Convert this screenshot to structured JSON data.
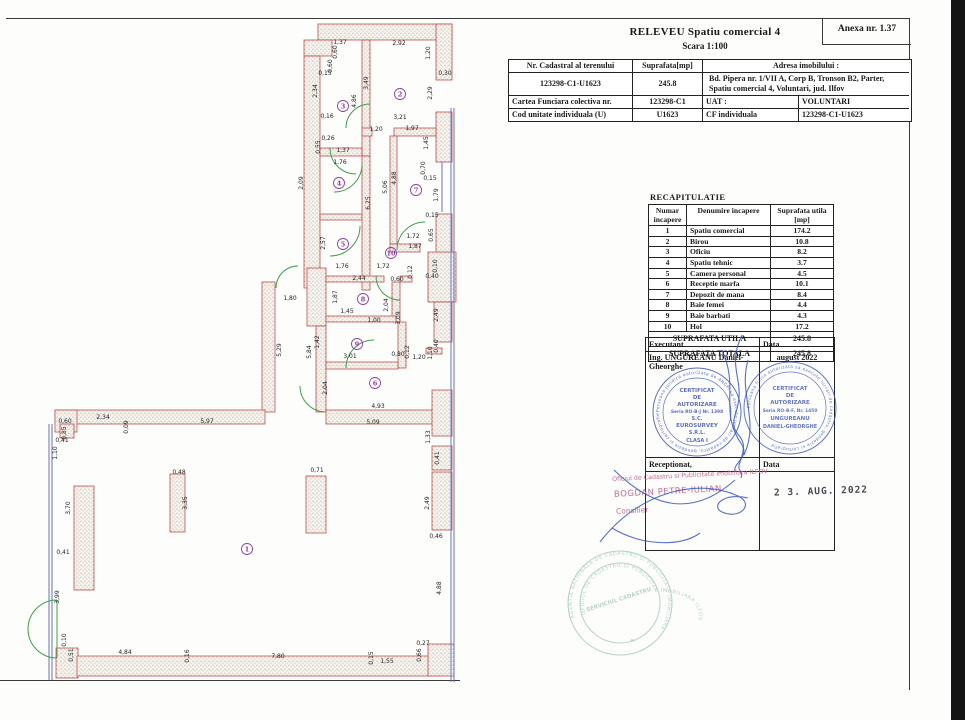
{
  "page": {
    "anexa": "Anexa nr. 1.37",
    "title": "RELEVEU   Spatiu comercial 4",
    "scale": "Scara 1:100"
  },
  "header_table": {
    "col1_label": "Nr. Cadastral al terenului",
    "col2_label": "Suprafata[mp]",
    "col3_label": "Adresa imobilului :",
    "cadastral_no": "123298-C1-U1623",
    "area": "245.8",
    "address": "Bd. Pipera nr. 1/VII A, Corp B, Tronson B2, Parter, Spatiu comercial 4, Voluntari, jud. Ilfov",
    "row3_label": "Cartea Funciara colectiva nr.",
    "row3_value": "123298-C1",
    "row3_label2": "UAT :",
    "row3_value2": "VOLUNTARI",
    "row4_label": "Cod unitate individuala (U)",
    "row4_value": "U1623",
    "row4_label2": "CF individuala",
    "row4_value2": "123298-C1-U1623"
  },
  "recap_table": {
    "title": "RECAPITULATIE",
    "header_col1": "Numar incapere",
    "header_col2": "Denumire incapere",
    "header_col3": "Suprafata utila [mp]",
    "rows": [
      [
        "1",
        "Spatiu comercial",
        "174.2"
      ],
      [
        "2",
        "Birou",
        "10.8"
      ],
      [
        "3",
        "Oficiu",
        "8.2"
      ],
      [
        "4",
        "Spatiu tehnic",
        "3.7"
      ],
      [
        "5",
        "Camera personal",
        "4.5"
      ],
      [
        "6",
        "Receptie marfa",
        "10.1"
      ],
      [
        "7",
        "Depozit de mana",
        "8.4"
      ],
      [
        "8",
        "Baie femei",
        "4.4"
      ],
      [
        "9",
        "Baie barbati",
        "4.3"
      ],
      [
        "10",
        "Hol",
        "17.2"
      ]
    ],
    "total_util_label": "SUPRAFATA UTILA",
    "total_util": "245.8",
    "total_label": "SUPRAFATA TOTALA",
    "total": "245.8"
  },
  "signature_table": {
    "executant_label": "Executant",
    "data_label": "Data",
    "executant": "Ing. UNGUREANU Daniel-Gheorghe",
    "executant_date": "august 2022",
    "receptionat_label": "Receptionat,",
    "data_label2": "Data",
    "reception_stamp_line1": "Oficiul de Cadastru si Publicitate Imobiliara ILFOV",
    "reception_stamp_line2": "BOGDAN PETRE-IULIAN",
    "reception_stamp_line3": "Consilier",
    "reception_date": "2 3. AUG. 2022"
  },
  "stamps": {
    "stamp1_ring": "Persoana juridica autorizata de ANCPI sa execute lucrari de cadastru, geodezie si cartografie",
    "stamp1_lines": [
      "CERTIFICAT",
      "DE",
      "AUTORIZARE",
      "Seria RO-B-J Nr. 1398",
      "S.C.",
      "EUROSURVEY",
      "S.R.L.",
      "CLASA I"
    ],
    "stamp2_ring": "Persoana fizica autorizata sa execute lucrari de cadastru, geodezie si cartografie",
    "stamp2_lines": [
      "CERTIFICAT",
      "DE",
      "AUTORIZARE",
      "Seria RO-B-F, Nr. 1450",
      "UNGUREANU",
      "DANIEL-GHEORGHE"
    ],
    "round_stamp_outer": "AGENTIA NATIONALA DE CADASTRU SI PUBLICITATE IMOBILIARA",
    "round_stamp_inner": "OFICIUL DE CADASTRU SI PUBLICITATE IMOBILIARA ILFOV",
    "round_stamp_center": "SERVICIUL CADASTRU"
  },
  "plan": {
    "colors": {
      "wall": "#c0504d",
      "window": "#6674b8",
      "door": "#3f9e4d",
      "room_number": "#8b3f9e"
    },
    "rooms": [
      [
        1,
        247,
        549
      ],
      [
        2,
        400,
        94
      ],
      [
        3,
        343,
        106
      ],
      [
        4,
        339,
        183
      ],
      [
        5,
        343,
        244
      ],
      [
        6,
        375,
        383
      ],
      [
        7,
        416,
        190
      ],
      [
        8,
        363,
        299
      ],
      [
        9,
        357,
        344
      ],
      [
        10,
        391,
        253
      ]
    ],
    "dims": [
      [
        "1,37",
        340,
        44,
        0
      ],
      [
        "0,60",
        337,
        52,
        1
      ],
      [
        "2,92",
        399,
        45,
        0
      ],
      [
        "1,20",
        430,
        53,
        1
      ],
      [
        "0,60",
        332,
        66,
        1
      ],
      [
        "0,15",
        325,
        75,
        0
      ],
      [
        "0,30",
        445,
        75,
        0
      ],
      [
        "2,34",
        317,
        91,
        1
      ],
      [
        "3,49",
        368,
        83,
        1
      ],
      [
        "4,86",
        356,
        101,
        1
      ],
      [
        "2,29",
        432,
        93,
        1
      ],
      [
        "0,16",
        327,
        118,
        0
      ],
      [
        "3,21",
        400,
        119,
        0
      ],
      [
        "1,20",
        376,
        131,
        0
      ],
      [
        "1,97",
        412,
        130,
        0
      ],
      [
        "1,45",
        428,
        143,
        1
      ],
      [
        "0,26",
        328,
        140,
        0
      ],
      [
        "0,55",
        320,
        147,
        1
      ],
      [
        "1,37",
        343,
        152,
        0
      ],
      [
        "1,76",
        340,
        164,
        0
      ],
      [
        "2,09",
        303,
        183,
        1
      ],
      [
        "6,25",
        370,
        203,
        1
      ],
      [
        "5,06",
        387,
        187,
        1
      ],
      [
        "4,88",
        396,
        178,
        1
      ],
      [
        "0,70",
        425,
        168,
        1
      ],
      [
        "0,15",
        430,
        180,
        0
      ],
      [
        "1,79",
        438,
        195,
        1
      ],
      [
        "0,15",
        432,
        217,
        0
      ],
      [
        "0,65",
        433,
        235,
        1
      ],
      [
        "1,72",
        413,
        238,
        0
      ],
      [
        "1,87",
        415,
        248,
        0
      ],
      [
        "2,57",
        325,
        243,
        1
      ],
      [
        "1,76",
        342,
        268,
        0
      ],
      [
        "2,44",
        359,
        280,
        0
      ],
      [
        "1,72",
        383,
        268,
        0
      ],
      [
        "0,60",
        397,
        281,
        0
      ],
      [
        "0,12",
        412,
        272,
        1
      ],
      [
        "0,40",
        432,
        278,
        0
      ],
      [
        "0,10",
        437,
        266,
        1
      ],
      [
        "1,80",
        290,
        300,
        0
      ],
      [
        "1,87",
        337,
        297,
        1
      ],
      [
        "2,04",
        388,
        305,
        1
      ],
      [
        "1,45",
        347,
        313,
        0
      ],
      [
        "1,00",
        374,
        322,
        0
      ],
      [
        "3,09",
        400,
        318,
        1
      ],
      [
        "2,49",
        438,
        315,
        1
      ],
      [
        "1,42",
        319,
        342,
        1
      ],
      [
        "5,29",
        281,
        350,
        1
      ],
      [
        "5,84",
        311,
        352,
        1
      ],
      [
        "3,01",
        350,
        358,
        0
      ],
      [
        "0,80",
        398,
        356,
        0
      ],
      [
        "0,12",
        409,
        352,
        1
      ],
      [
        "1,20",
        419,
        359,
        0
      ],
      [
        "0,40",
        438,
        346,
        1
      ],
      [
        "1,10",
        432,
        353,
        1
      ],
      [
        "2,04",
        327,
        388,
        1
      ],
      [
        "4,93",
        378,
        408,
        0
      ],
      [
        "5,09",
        373,
        424,
        0
      ],
      [
        "0,60",
        65,
        423,
        0
      ],
      [
        "2,34",
        103,
        419,
        0
      ],
      [
        "0,09",
        128,
        427,
        1
      ],
      [
        "5,97",
        207,
        423,
        0
      ],
      [
        "0,85",
        66,
        433,
        1
      ],
      [
        "0,41",
        62,
        442,
        0
      ],
      [
        "1,10",
        57,
        453,
        1
      ],
      [
        "3,70",
        70,
        508,
        1
      ],
      [
        "0,41",
        63,
        554,
        0
      ],
      [
        "0,48",
        179,
        474,
        0
      ],
      [
        "3,35",
        187,
        503,
        1
      ],
      [
        "0,71",
        317,
        472,
        0
      ],
      [
        "1,33",
        430,
        437,
        1
      ],
      [
        "0,41",
        439,
        458,
        1
      ],
      [
        "2,49",
        429,
        503,
        1
      ],
      [
        "0,46",
        436,
        538,
        0
      ],
      [
        "3,99",
        59,
        597,
        1
      ],
      [
        "0,10",
        66,
        640,
        1
      ],
      [
        "0,51",
        73,
        655,
        1
      ],
      [
        "4,84",
        125,
        654,
        0
      ],
      [
        "0,16",
        189,
        656,
        1
      ],
      [
        "7,80",
        278,
        658,
        0
      ],
      [
        "0,15",
        373,
        658,
        1
      ],
      [
        "1,55",
        387,
        663,
        0
      ],
      [
        "0,66",
        421,
        655,
        1
      ],
      [
        "0,27",
        423,
        645,
        0
      ],
      [
        "4,88",
        441,
        588,
        1
      ]
    ]
  }
}
